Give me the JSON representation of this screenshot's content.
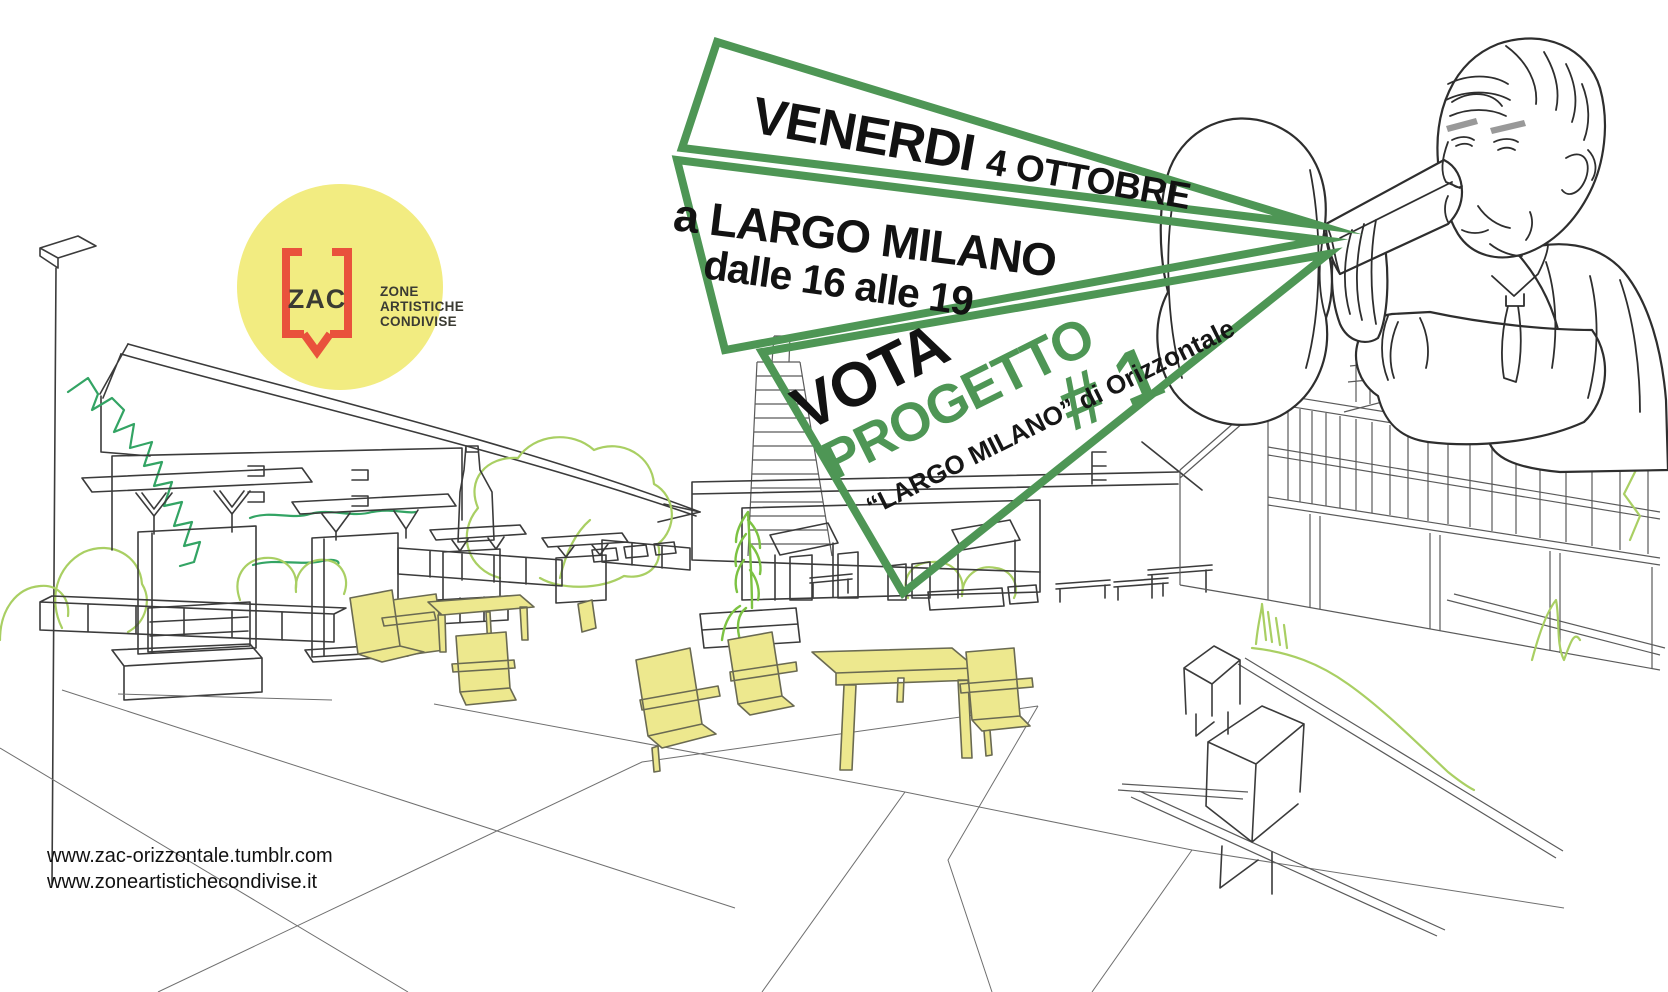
{
  "banners": {
    "banner1": {
      "part1": "VENERDI",
      "part2": "4 OTTOBRE"
    },
    "banner2": {
      "line1": "a LARGO MILANO",
      "line2": "dalle 16 alle 19"
    },
    "banner3": {
      "vota": "VOTA",
      "progetto": "PROGETTO",
      "number": "# 1",
      "caption": "“LARGO MILANO” di Orizzontale"
    }
  },
  "logo": {
    "acronym": "ZAC",
    "line1": "ZONE",
    "line2": "ARTISTICHE",
    "line3": "CONDIVISE"
  },
  "footer": {
    "url1": "www.zac-orizzontale.tumblr.com",
    "url2": "www.zoneartistichecondivise.it"
  },
  "colors": {
    "accent_green": "#4E9655",
    "furniture_yellow": "#EDE88E",
    "logo_yellow": "#F2EC81",
    "logo_red": "#E9523C",
    "ink": "#121212",
    "line_gray": "#3B3B3B",
    "green_light": "#A9CF63",
    "green_mid": "#33A464",
    "green_bright": "#7CC242"
  }
}
